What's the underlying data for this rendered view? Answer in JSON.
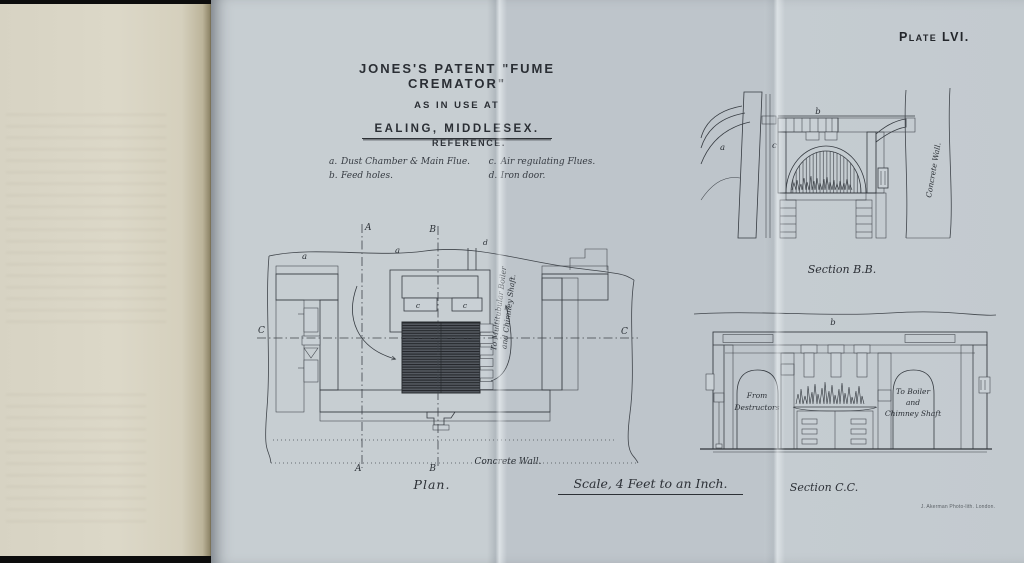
{
  "plate": {
    "plate_number": "Plate LVI.",
    "title": {
      "line1": "JONES'S PATENT \"FUME CREMATOR\"",
      "line2": "AS IN USE AT",
      "line3": "EALING, MIDDLESEX."
    },
    "reference": {
      "heading": "REFERENCE.",
      "entries": [
        {
          "key": "a.",
          "label": "Dust Chamber & Main Flue."
        },
        {
          "key": "c.",
          "label": "Air regulating Flues."
        },
        {
          "key": "b.",
          "label": "Feed holes."
        },
        {
          "key": "d.",
          "label": "Iron door."
        }
      ]
    },
    "letters": {
      "a": "a",
      "b": "b",
      "c": "c",
      "d": "d",
      "A": "A",
      "B": "B",
      "C": "C"
    },
    "plan": {
      "caption": "Plan.",
      "concrete_wall": "Concrete Wall.",
      "flue_line1": "To Multitubular Boiler",
      "flue_line2": "and Chimney Shaft."
    },
    "section_bb": {
      "caption": "Section B.B.",
      "concrete_wall": "Concrete Wall."
    },
    "section_cc": {
      "caption": "Section C.C.",
      "from_line1": "From",
      "from_line2": "Destructors",
      "to_line1": "To Boiler",
      "to_line2": "and",
      "to_line3": "Chimney Shaft"
    },
    "scale_note": "Scale, 4 Feet to an Inch.",
    "imprint": "J. Akerman Photo-lith. London."
  }
}
